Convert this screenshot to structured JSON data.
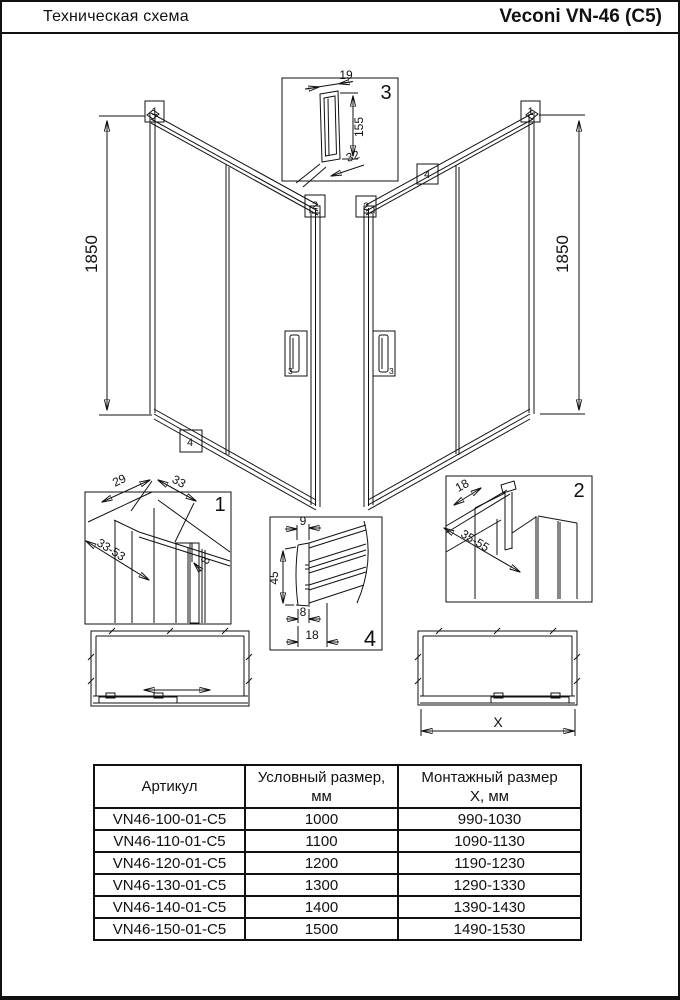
{
  "header": {
    "left": "Техническая схема",
    "right": "Veconi VN-46 (C5)"
  },
  "drawing": {
    "left_view": {
      "height": "1850"
    },
    "right_view": {
      "height": "1850"
    },
    "markers": {
      "m1": "1",
      "m2": "2",
      "m3": "3",
      "m4": "4"
    },
    "detail1": {
      "label": "1",
      "dim_29": "29",
      "dim_33": "33",
      "dim_33_53": "33-53",
      "dim_8": "8"
    },
    "detail2": {
      "label": "2",
      "dim_18": "18",
      "dim_35_55": "35-55"
    },
    "detail3": {
      "label": "3",
      "dim_19": "19",
      "dim_155": "155",
      "dim_32": "32"
    },
    "detail4": {
      "label": "4",
      "dim_9": "9",
      "dim_45": "45",
      "dim_8": "8",
      "dim_18": "18"
    },
    "top_view": {
      "x_label": "X"
    }
  },
  "table": {
    "col1_header": "Артикул",
    "col2_header_line1": "Условный размер,",
    "col2_header_line2": "мм",
    "col3_header_line1": "Монтажный размер",
    "col3_header_line2": "Х, мм",
    "rows": [
      [
        "VN46-100-01-C5",
        "1000",
        "990-1030"
      ],
      [
        "VN46-110-01-C5",
        "1100",
        "1090-1130"
      ],
      [
        "VN46-120-01-C5",
        "1200",
        "1190-1230"
      ],
      [
        "VN46-130-01-C5",
        "1300",
        "1290-1330"
      ],
      [
        "VN46-140-01-C5",
        "1400",
        "1390-1430"
      ],
      [
        "VN46-150-01-C5",
        "1500",
        "1490-1530"
      ]
    ]
  }
}
